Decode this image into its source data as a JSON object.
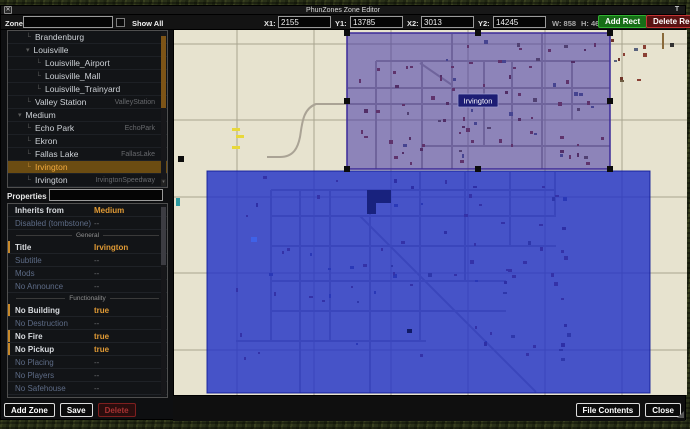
{
  "window": {
    "title": "PhunZones Zone Editor"
  },
  "toolbar": {
    "zones_label": "Zones",
    "zones_value": "",
    "show_all_label": "Show All",
    "x1_label": "X1:",
    "x1": "2155",
    "y1_label": "Y1:",
    "y1": "13785",
    "x2_label": "X2:",
    "x2": "3013",
    "y2_label": "Y2:",
    "y2": "14245",
    "w_label": "W: 858",
    "h_label": "H: 460",
    "add_rect_label": "Add Rect",
    "delete_rect_label": "Delete Rect"
  },
  "sidebar": {
    "tree": {
      "items": [
        {
          "label": "Brandenburg",
          "right": "",
          "level": 2,
          "expander": false,
          "selected": false
        },
        {
          "label": "Louisville",
          "right": "",
          "level": 2,
          "expander": true,
          "selected": false
        },
        {
          "label": "Louisville_Airport",
          "right": "",
          "level": 3,
          "expander": false,
          "selected": false
        },
        {
          "label": "Louisville_Mall",
          "right": "",
          "level": 3,
          "expander": false,
          "selected": false
        },
        {
          "label": "Louisville_Trainyard",
          "right": "",
          "level": 3,
          "expander": false,
          "selected": false
        },
        {
          "label": "Valley Station",
          "right": "ValleyStation",
          "level": 2,
          "expander": false,
          "selected": false
        },
        {
          "label": "Medium",
          "right": "",
          "level": 1,
          "expander": true,
          "selected": false
        },
        {
          "label": "Echo Park",
          "right": "EchoPark",
          "level": 2,
          "expander": false,
          "selected": false
        },
        {
          "label": "Ekron",
          "right": "",
          "level": 2,
          "expander": false,
          "selected": false
        },
        {
          "label": "Fallas Lake",
          "right": "FallasLake",
          "level": 2,
          "expander": false,
          "selected": false
        },
        {
          "label": "Irvington",
          "right": "",
          "level": 2,
          "expander": false,
          "selected": true
        },
        {
          "label": "Irvington",
          "right": "IrvingtonSpeedway",
          "level": 2,
          "expander": false,
          "selected": false
        }
      ]
    },
    "properties": {
      "header": "Properties",
      "filter_value": "",
      "rows": [
        {
          "type": "row",
          "label": "Inherits from",
          "value": "Medium",
          "muted": false,
          "bar": false
        },
        {
          "type": "row",
          "label": "Disabled (tombstone)",
          "value": "--",
          "muted": true,
          "bar": false
        },
        {
          "type": "divider",
          "label": "General"
        },
        {
          "type": "row",
          "label": "Title",
          "value": "Irvington",
          "muted": false,
          "bar": true
        },
        {
          "type": "row",
          "label": "Subtitle",
          "value": "--",
          "muted": true,
          "bar": false
        },
        {
          "type": "row",
          "label": "Mods",
          "value": "--",
          "muted": true,
          "bar": false
        },
        {
          "type": "row",
          "label": "No Announce",
          "value": "--",
          "muted": true,
          "bar": false
        },
        {
          "type": "divider",
          "label": "Functionality"
        },
        {
          "type": "row",
          "label": "No Building",
          "value": "true",
          "muted": false,
          "bar": true
        },
        {
          "type": "row",
          "label": "No Destruction",
          "value": "--",
          "muted": true,
          "bar": false
        },
        {
          "type": "row",
          "label": "No Fire",
          "value": "true",
          "muted": false,
          "bar": true
        },
        {
          "type": "row",
          "label": "No Pickup",
          "value": "true",
          "muted": false,
          "bar": true
        },
        {
          "type": "row",
          "label": "No Placing",
          "value": "--",
          "muted": true,
          "bar": false
        },
        {
          "type": "row",
          "label": "No Players",
          "value": "--",
          "muted": true,
          "bar": false
        },
        {
          "type": "row",
          "label": "No Safehouse",
          "value": "--",
          "muted": true,
          "bar": false
        }
      ]
    }
  },
  "map": {
    "zone_label": "Irvington"
  },
  "footer": {
    "add_zone": "Add Zone",
    "save": "Save",
    "delete": "Delete",
    "file_contents": "File Contents",
    "close": "Close"
  },
  "colors": {
    "accent_orange": "#e09a35",
    "selected_row": "#6b4c12",
    "zone_blue": "rgba(30,46,198,0.8)",
    "zone_purple": "rgba(52,38,164,0.5)",
    "add_green": "#176e17",
    "delete_red": "#5a1212",
    "map_beige": "#e7e3cf"
  }
}
